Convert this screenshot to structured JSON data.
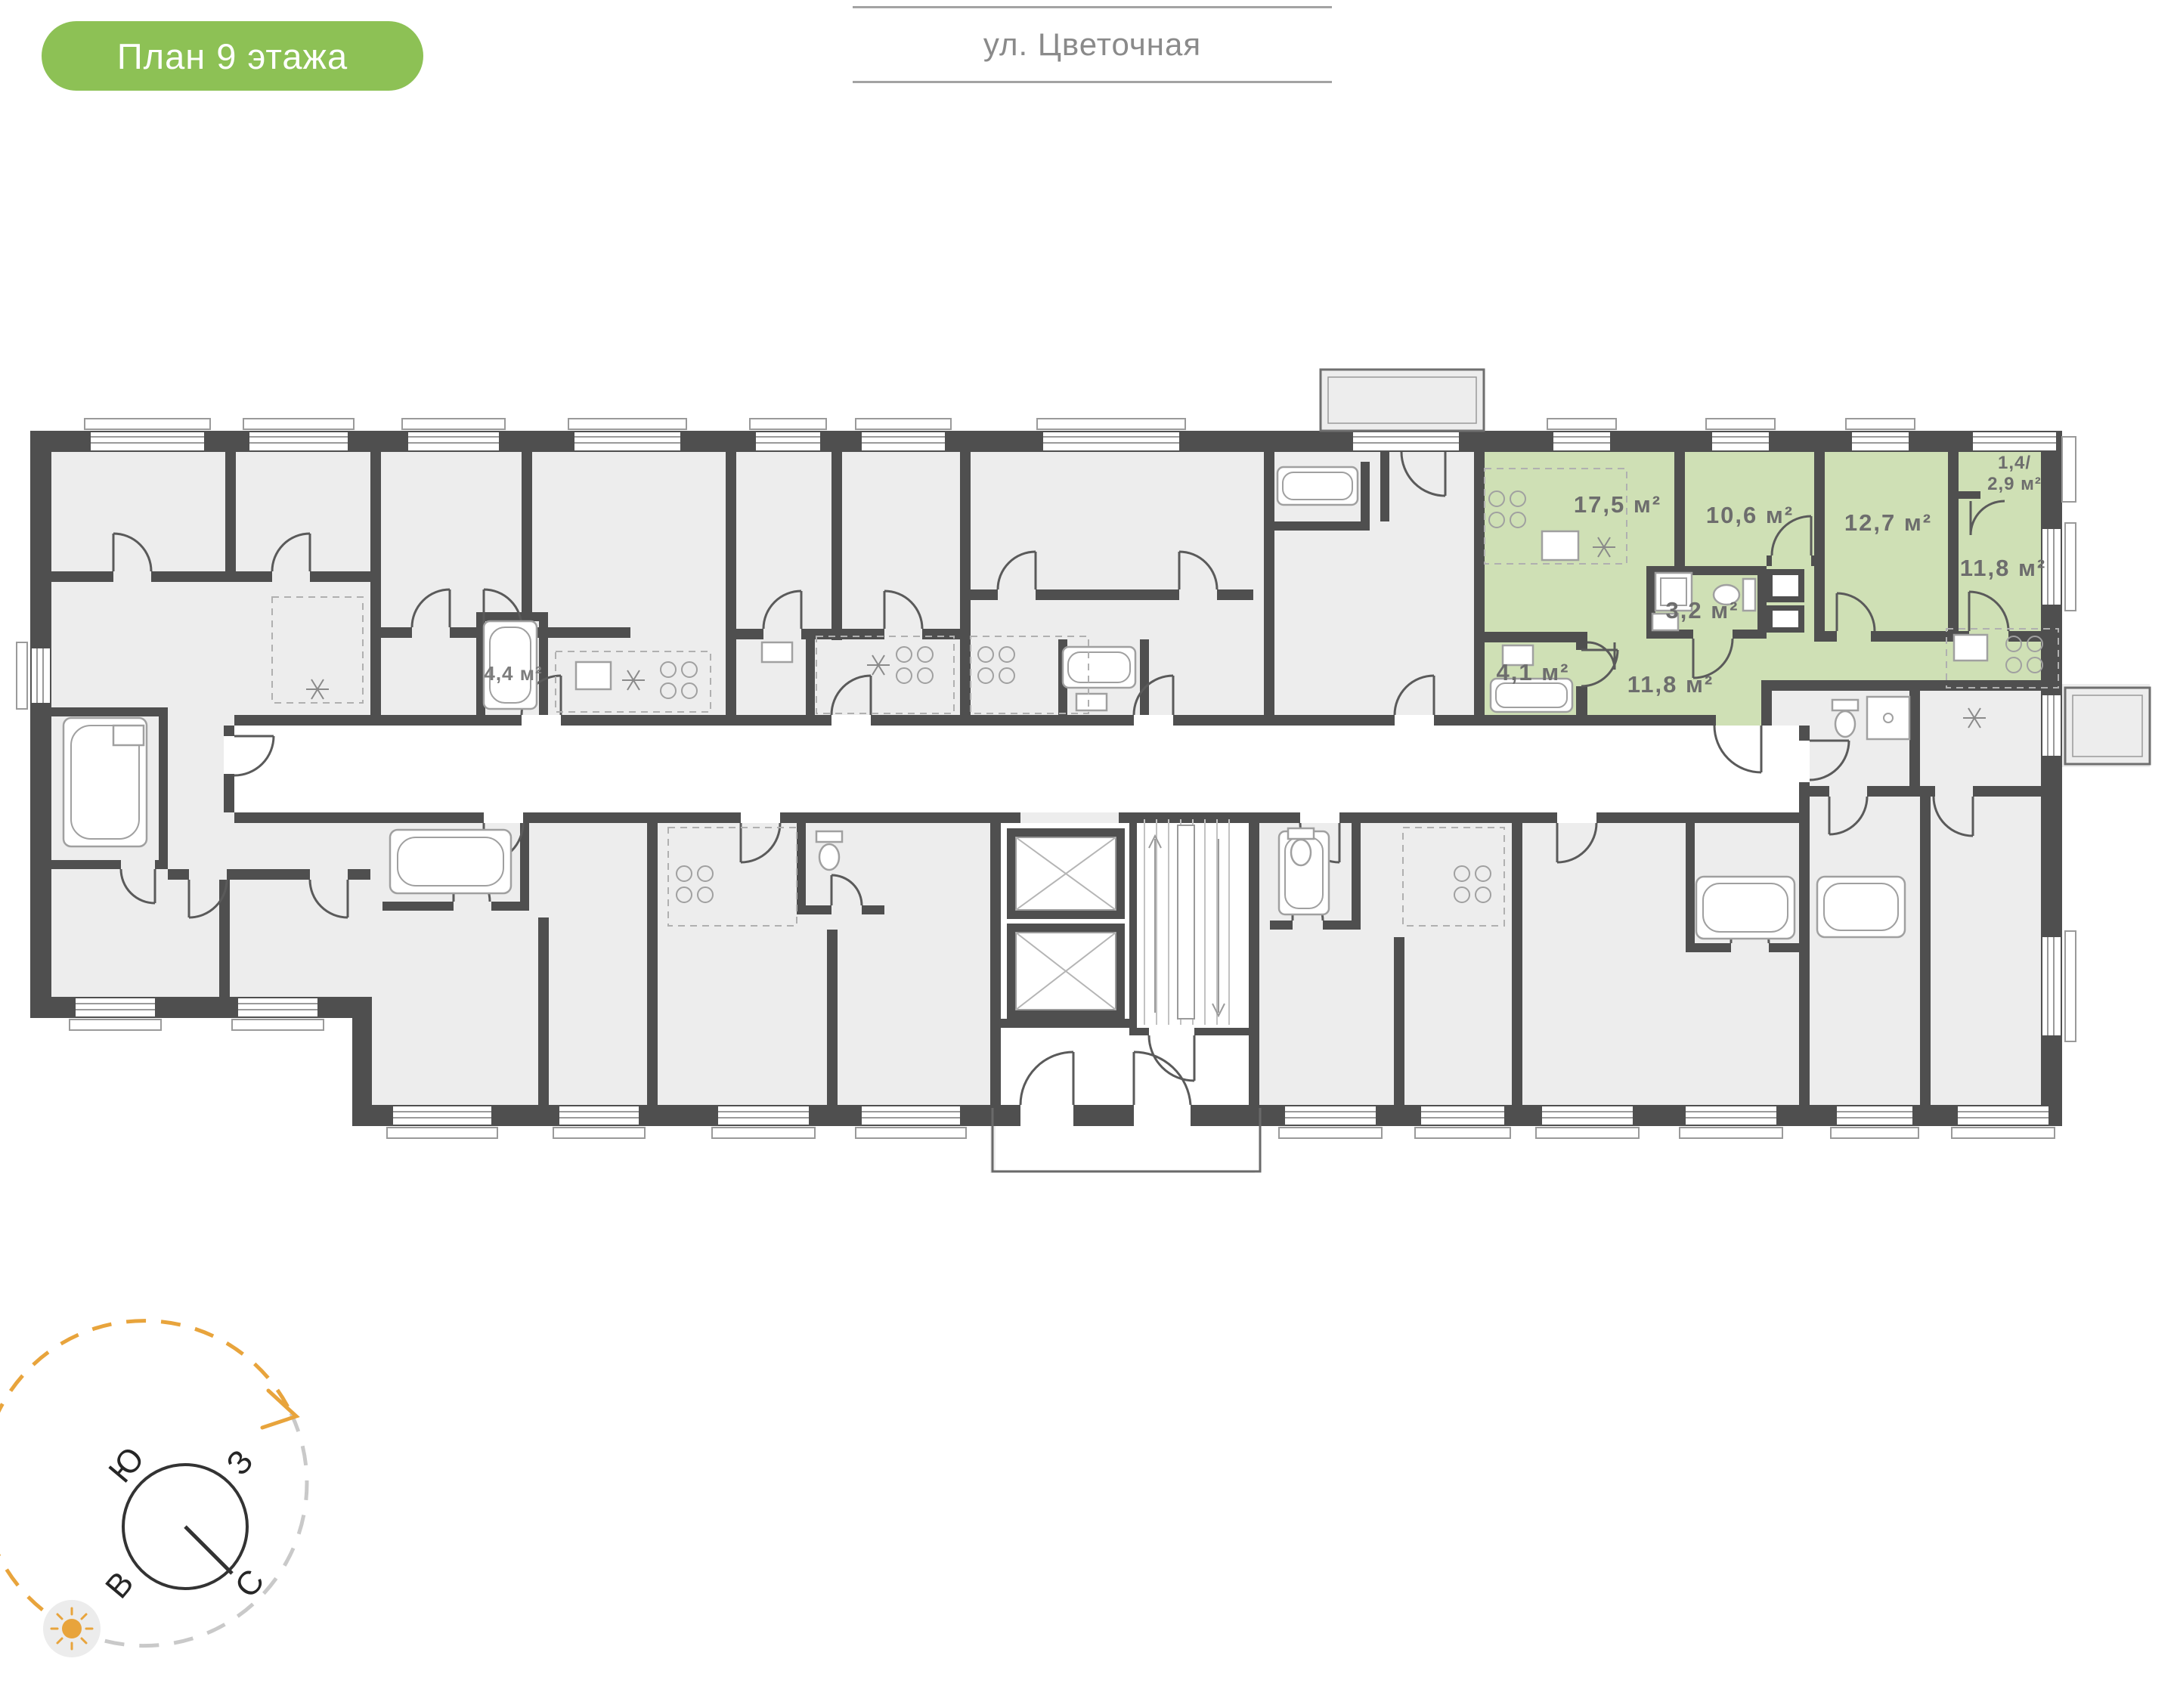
{
  "badge": {
    "label": "План 9 этажа"
  },
  "street": {
    "label": "ул. Цветочная"
  },
  "floor_plan": {
    "highlighted_apartment": {
      "rooms": [
        {
          "name": "living-kitchen",
          "area_label": "17,5 м²"
        },
        {
          "name": "bedroom-1",
          "area_label": "10,6 м²"
        },
        {
          "name": "bedroom-2",
          "area_label": "12,7 м²"
        },
        {
          "name": "bedroom-3",
          "area_label": "11,8 м²"
        },
        {
          "name": "bathroom",
          "area_label": "3,2 м²"
        },
        {
          "name": "bathroom-2",
          "area_label": "4,1 м²"
        },
        {
          "name": "hallway",
          "area_label": "11,8 м²"
        },
        {
          "name": "balcony",
          "area_label_line1": "1,4/",
          "area_label_line2": "2,9 м²"
        }
      ]
    },
    "other_labels": [
      {
        "name": "neighbor-bathroom",
        "area_label": "4,4 м²"
      }
    ]
  },
  "compass": {
    "south_label": "Ю",
    "west_label": "З",
    "east_label": "В",
    "north_label": "С"
  },
  "colors": {
    "badge_bg": "#8dc155",
    "apartment_highlight": "#cfe0b5",
    "walls": "#4f4f4f",
    "floor": "#ededed",
    "compass_arrow": "#e8a43c"
  }
}
